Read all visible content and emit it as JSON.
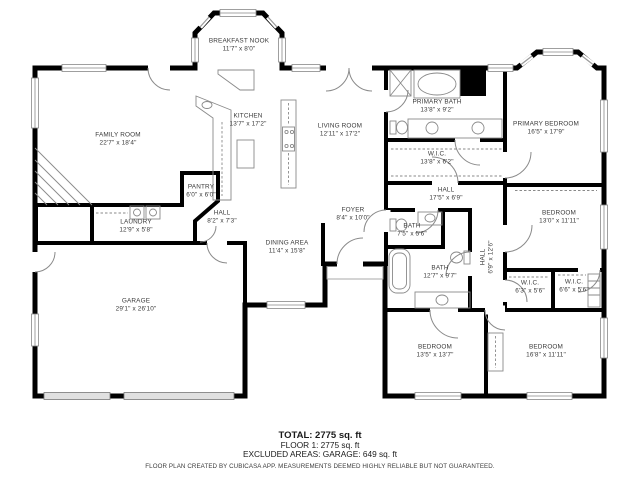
{
  "rooms": [
    {
      "name": "BREAKFAST NOOK",
      "dims": "11'7\" x 8'0\""
    },
    {
      "name": "FAMILY ROOM",
      "dims": "22'7\" x 18'4\""
    },
    {
      "name": "KITCHEN",
      "dims": "13'7\" x 17'2\""
    },
    {
      "name": "LIVING ROOM",
      "dims": "12'11\" x 17'2\""
    },
    {
      "name": "PRIMARY BATH",
      "dims": "13'8\" x 9'2\""
    },
    {
      "name": "W.I.C.",
      "dims": "13'8\" x 6'2\""
    },
    {
      "name": "PRIMARY BEDROOM",
      "dims": "16'5\" x 17'9\""
    },
    {
      "name": "PANTRY",
      "dims": "6'0\" x 6'0\""
    },
    {
      "name": "HALL",
      "dims": "8'2\" x 7'3\""
    },
    {
      "name": "LAUNDRY",
      "dims": "12'9\" x 5'8\""
    },
    {
      "name": "DINING AREA",
      "dims": "11'4\" x 15'8\""
    },
    {
      "name": "FOYER",
      "dims": "8'4\" x 10'0\""
    },
    {
      "name": "HALL",
      "dims": "17'5\" x 6'9\""
    },
    {
      "name": "BATH",
      "dims": "7'5\" x 5'6\""
    },
    {
      "name": "BATH",
      "dims": "12'7\" x 9'7\""
    },
    {
      "name": "HALL",
      "dims": "6'9\" x 12'6\""
    },
    {
      "name": "BEDROOM",
      "dims": "13'0\" x 11'11\""
    },
    {
      "name": "W.I.C.",
      "dims": "6'3\" x 5'6\""
    },
    {
      "name": "W.I.C.",
      "dims": "6'6\" x 5'6\""
    },
    {
      "name": "BEDROOM",
      "dims": "13'5\" x 13'7\""
    },
    {
      "name": "BEDROOM",
      "dims": "16'8\" x 11'11\""
    },
    {
      "name": "GARAGE",
      "dims": "29'1\" x 26'10\""
    }
  ],
  "summary": {
    "total": "TOTAL: 2775 sq. ft",
    "floor1": "FLOOR 1: 2775 sq. ft",
    "excluded": "EXCLUDED AREAS: GARAGE: 649 sq. ft",
    "disclaimer": "FLOOR PLAN CREATED BY CUBICASA APP. MEASUREMENTS DEEMED HIGHLY RELIABLE BUT NOT GUARANTEED."
  },
  "colors": {
    "wall": "#000000",
    "fixture": "#8a8a8a",
    "window": "#888888",
    "label": "#3a3a3a"
  }
}
